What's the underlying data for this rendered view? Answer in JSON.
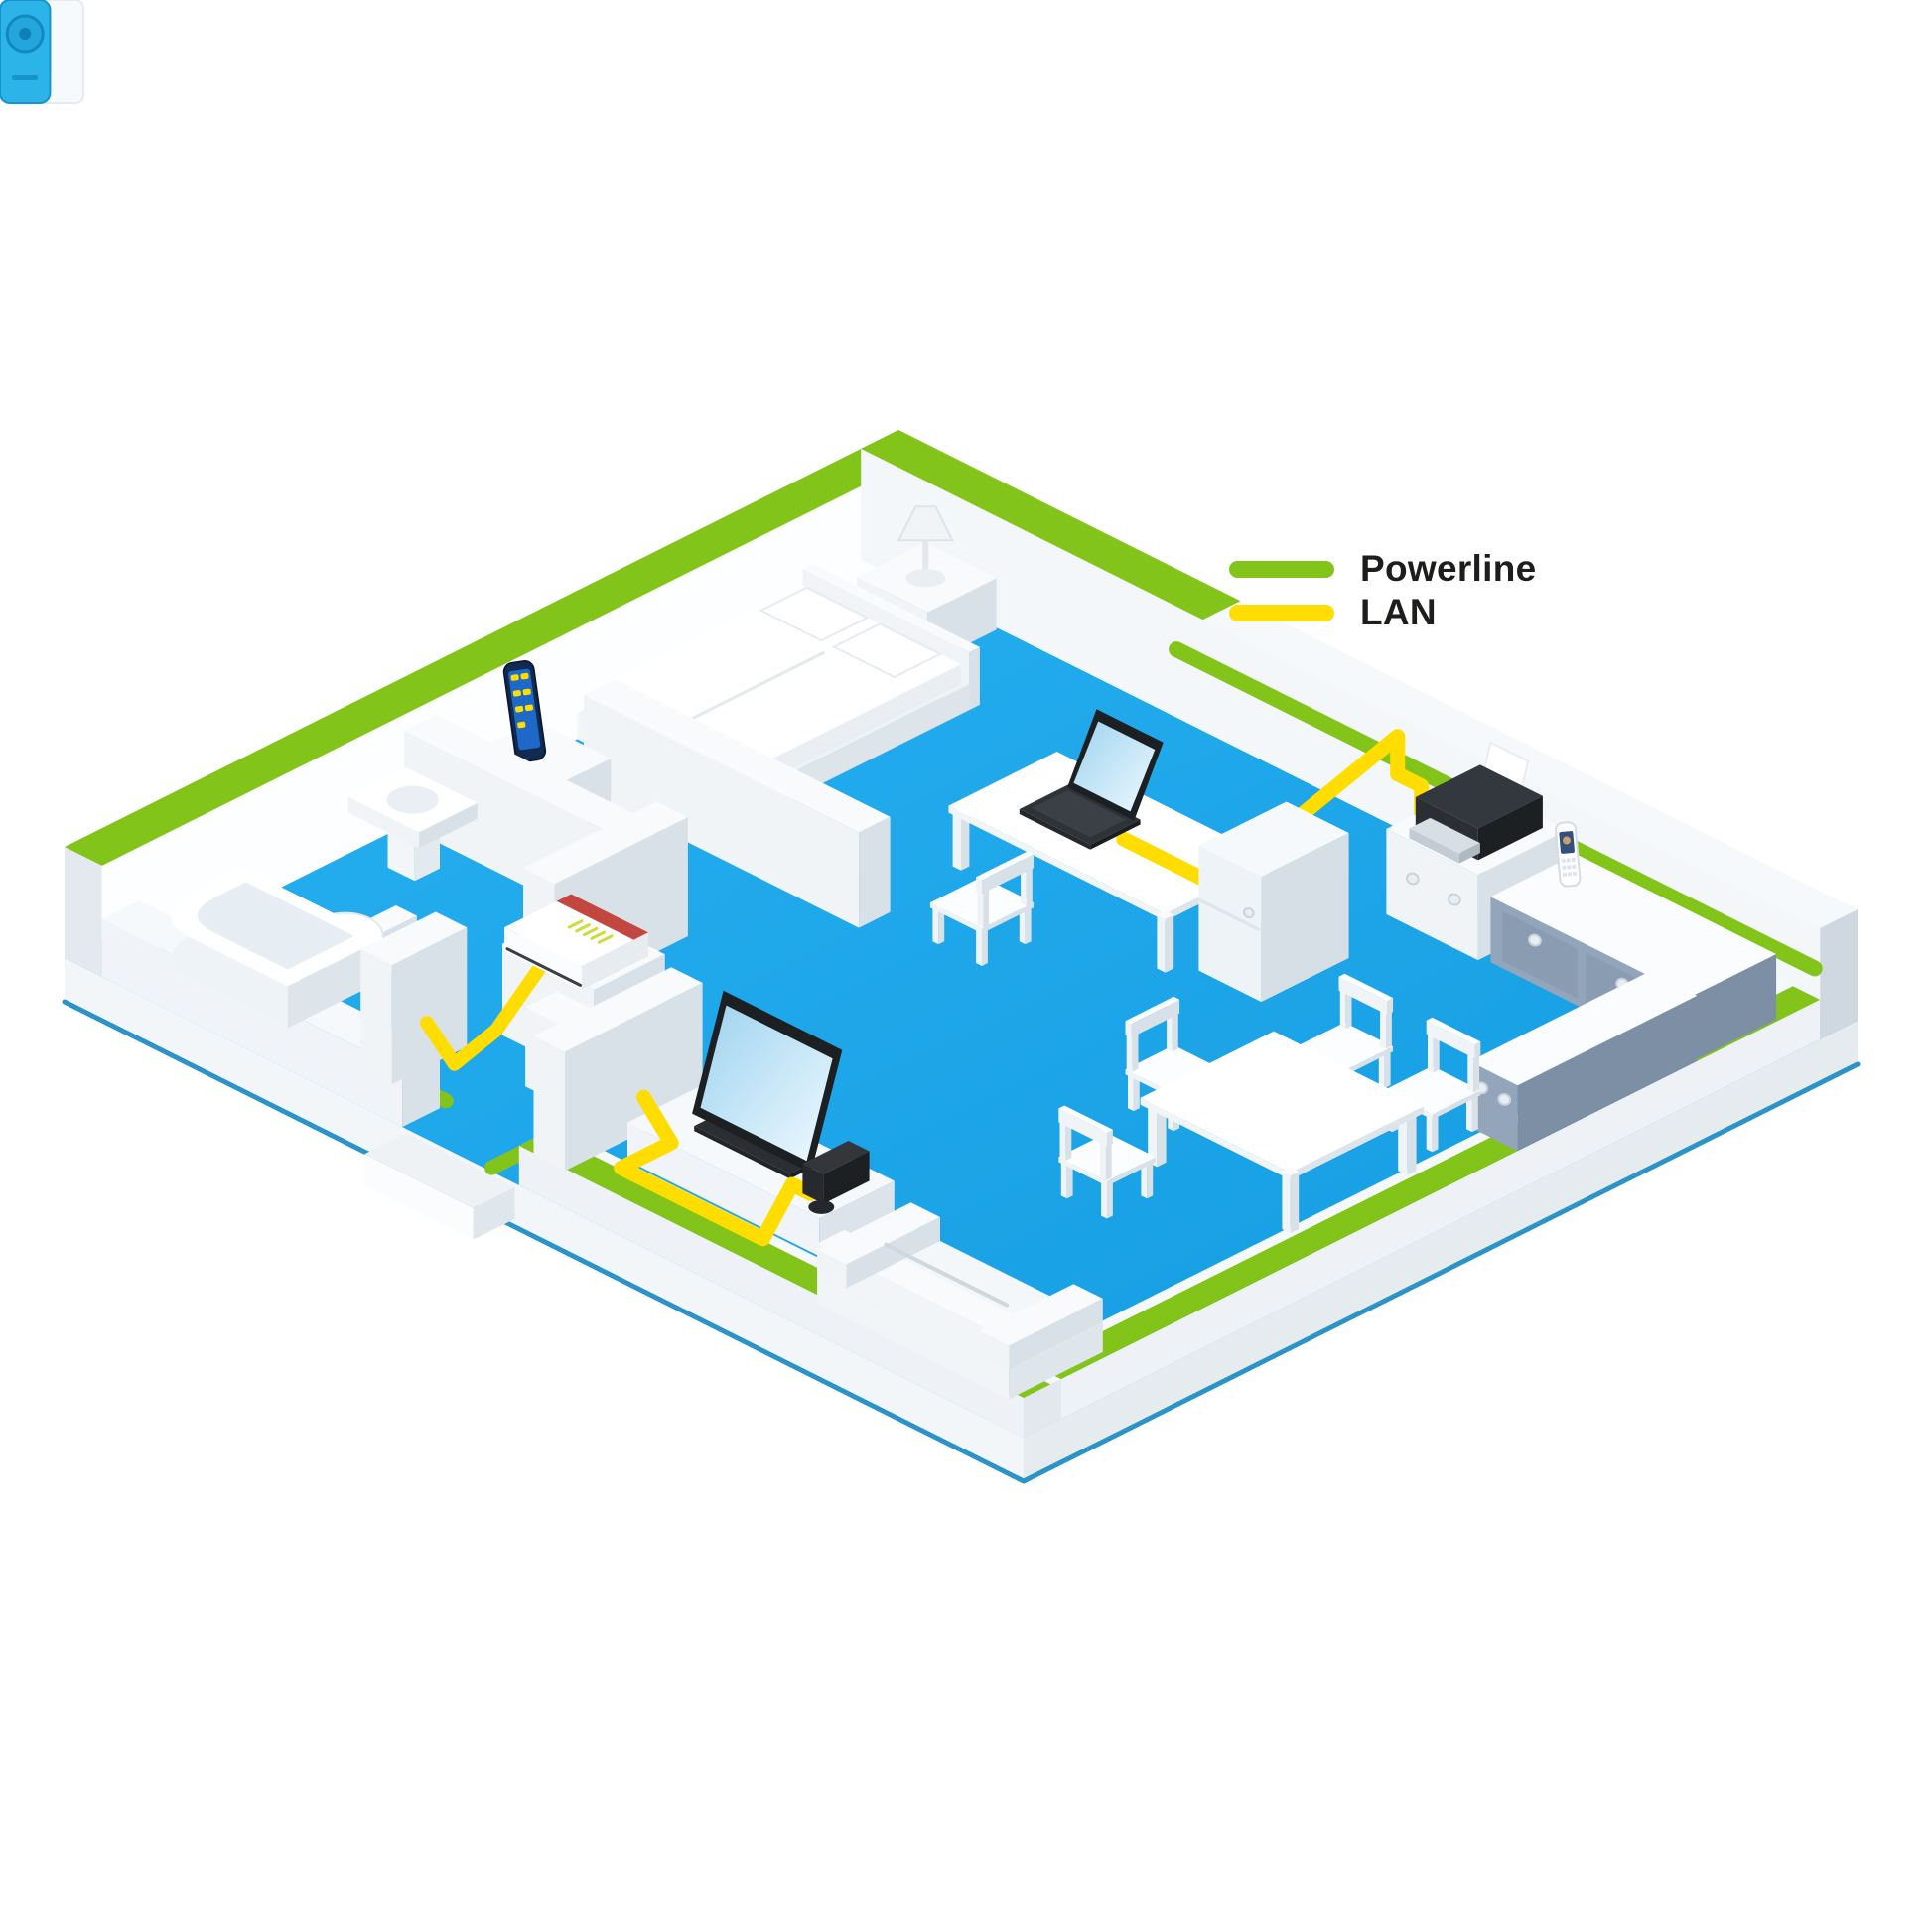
{
  "legend": {
    "items": [
      {
        "id": "powerline",
        "label": "Powerline",
        "color": "#83C41A"
      },
      {
        "id": "lan",
        "label": "LAN",
        "color": "#FFDD00"
      }
    ]
  },
  "scene": {
    "colors": {
      "floor": "#1BA7EB",
      "floor_light": "#27B1F2",
      "floor_dark": "#149BE0",
      "slab_edge": "#2A93C8",
      "wall_white": "#FDFEFF",
      "wall_light": "#F4F7FA",
      "wall_shade": "#D9E1E8",
      "powerline": "#83C41A",
      "lan": "#FFDD00",
      "adapter_cyan": "#2CB4E9",
      "adapter_cyan_dark": "#1693CC",
      "router_red": "#C4473F",
      "device_dark": "#24272B",
      "cabinet_slate": "#93A5BA"
    },
    "rooms": [
      "bathroom",
      "bedroom",
      "hallway",
      "office",
      "kitchen",
      "dining-area",
      "living-room"
    ],
    "devices": [
      "fritzbox-router",
      "powerline-adapter-hall",
      "powerline-adapter-office",
      "powerline-adapter-living",
      "smartphone",
      "laptop",
      "printer",
      "cordless-phone",
      "tv",
      "game-console"
    ]
  }
}
